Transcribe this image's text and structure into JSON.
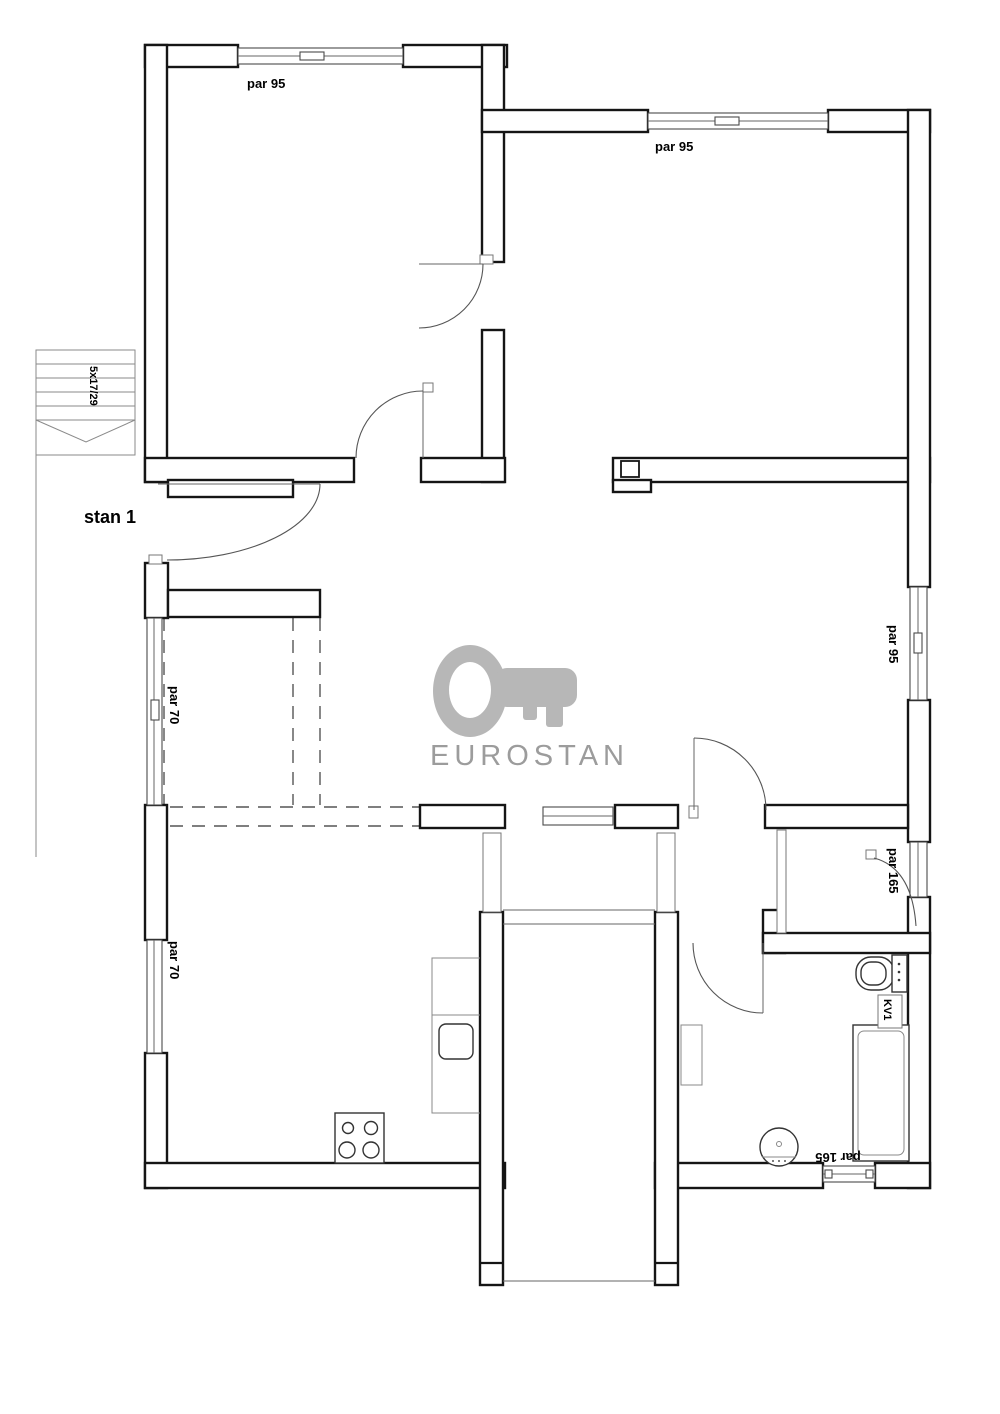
{
  "plan_type": "floor-plan",
  "watermark": {
    "brand": "EUROSTAN",
    "icon": "key-icon"
  },
  "unit_label": "stan 1",
  "stairs_label": "5x17/29",
  "windows": {
    "top_left": "par 95",
    "top_right": "par 95",
    "right_upper": "par 95",
    "right_mid": "par 165",
    "left_upper": "par 70",
    "left_lower": "par 70",
    "bottom": "par 165"
  },
  "fixtures": {
    "tub_label": "KV1",
    "items": [
      "stairs",
      "entrance-door",
      "toilet",
      "bathtub",
      "washbasin",
      "stove",
      "kitchen-sink",
      "wardrobe",
      "kitchen-counter"
    ]
  },
  "colors": {
    "wall": "#151515",
    "thin_line": "#555555",
    "watermark_icon": "#b7b7b7",
    "watermark_text": "#9c9c9c",
    "label_text": "#000000",
    "background": "#ffffff"
  }
}
